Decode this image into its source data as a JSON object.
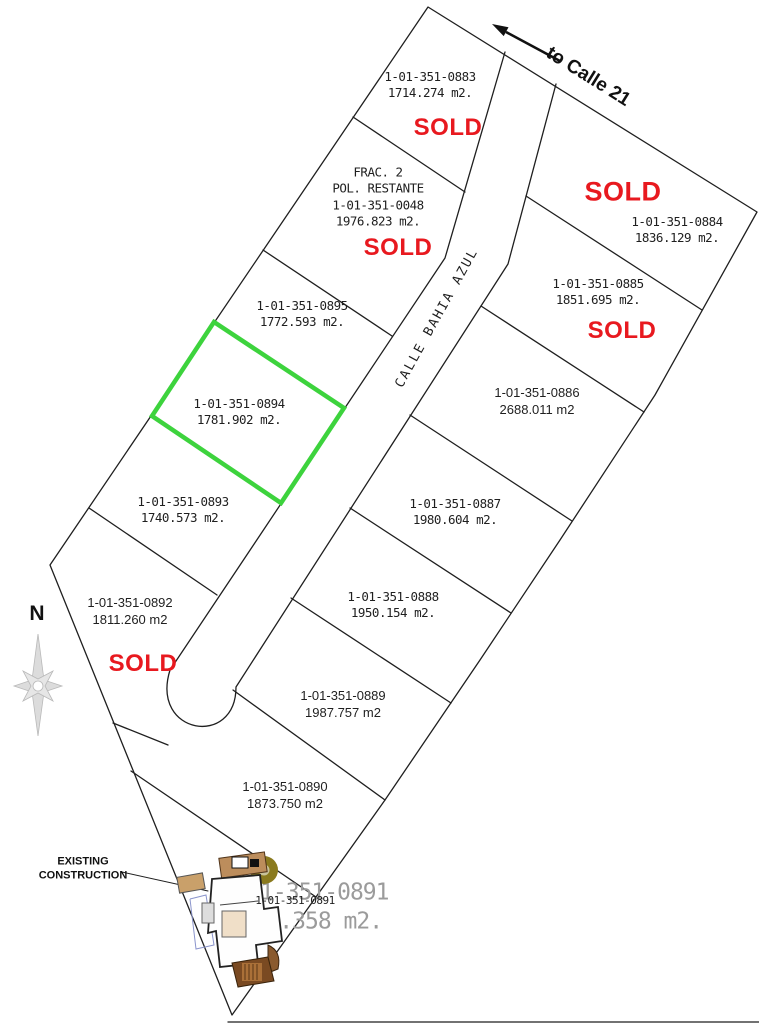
{
  "drawing": {
    "compass_label": "N",
    "street_label": "CALLE BAHIA AZUL",
    "direction_label": "to Calle 21",
    "construction_note_line1": "EXISTING",
    "construction_note_line2": "CONSTRUCTION",
    "colors": {
      "sold": "#e8191f",
      "highlight": "#3dd33d",
      "line": "#1f1f1f",
      "muted": "#9b9b9b"
    },
    "lots": [
      {
        "id": "1-01-351-0883",
        "area": "1714.274 m2.",
        "status": "SOLD",
        "highlighted": false
      },
      {
        "name_line1": "FRAC. 2",
        "name_line2": "POL. RESTANTE",
        "id": "1-01-351-0048",
        "area": "1976.823 m2.",
        "status": "SOLD",
        "highlighted": false
      },
      {
        "id": "1-01-351-0895",
        "area": "1772.593 m2.",
        "status": "",
        "highlighted": false
      },
      {
        "id": "1-01-351-0894",
        "area": "1781.902 m2.",
        "status": "",
        "highlighted": true
      },
      {
        "id": "1-01-351-0893",
        "area": "1740.573 m2.",
        "status": "",
        "highlighted": false
      },
      {
        "id": "1-01-351-0892",
        "area": "1811.260 m2",
        "status": "SOLD",
        "highlighted": false
      },
      {
        "id": "1-01-351-0884",
        "area": "1836.129 m2.",
        "status": "SOLD",
        "highlighted": false
      },
      {
        "id": "1-01-351-0885",
        "area": "1851.695 m2.",
        "status": "SOLD",
        "highlighted": false
      },
      {
        "id": "1-01-351-0886",
        "area": "2688.011 m2",
        "status": "",
        "highlighted": false
      },
      {
        "id": "1-01-351-0887",
        "area": "1980.604 m2.",
        "status": "",
        "highlighted": false
      },
      {
        "id": "1-01-351-0888",
        "area": "1950.154 m2.",
        "status": "",
        "highlighted": false
      },
      {
        "id": "1-01-351-0889",
        "area": "1987.757 m2",
        "status": "",
        "highlighted": false
      },
      {
        "id": "1-01-351-0890",
        "area": "1873.750 m2",
        "status": "",
        "highlighted": false
      },
      {
        "id": "1-01-351-0891",
        "area": "1944.358 m2.",
        "overlay_id": "1-01-351-0891",
        "status": "",
        "highlighted": false
      }
    ]
  }
}
